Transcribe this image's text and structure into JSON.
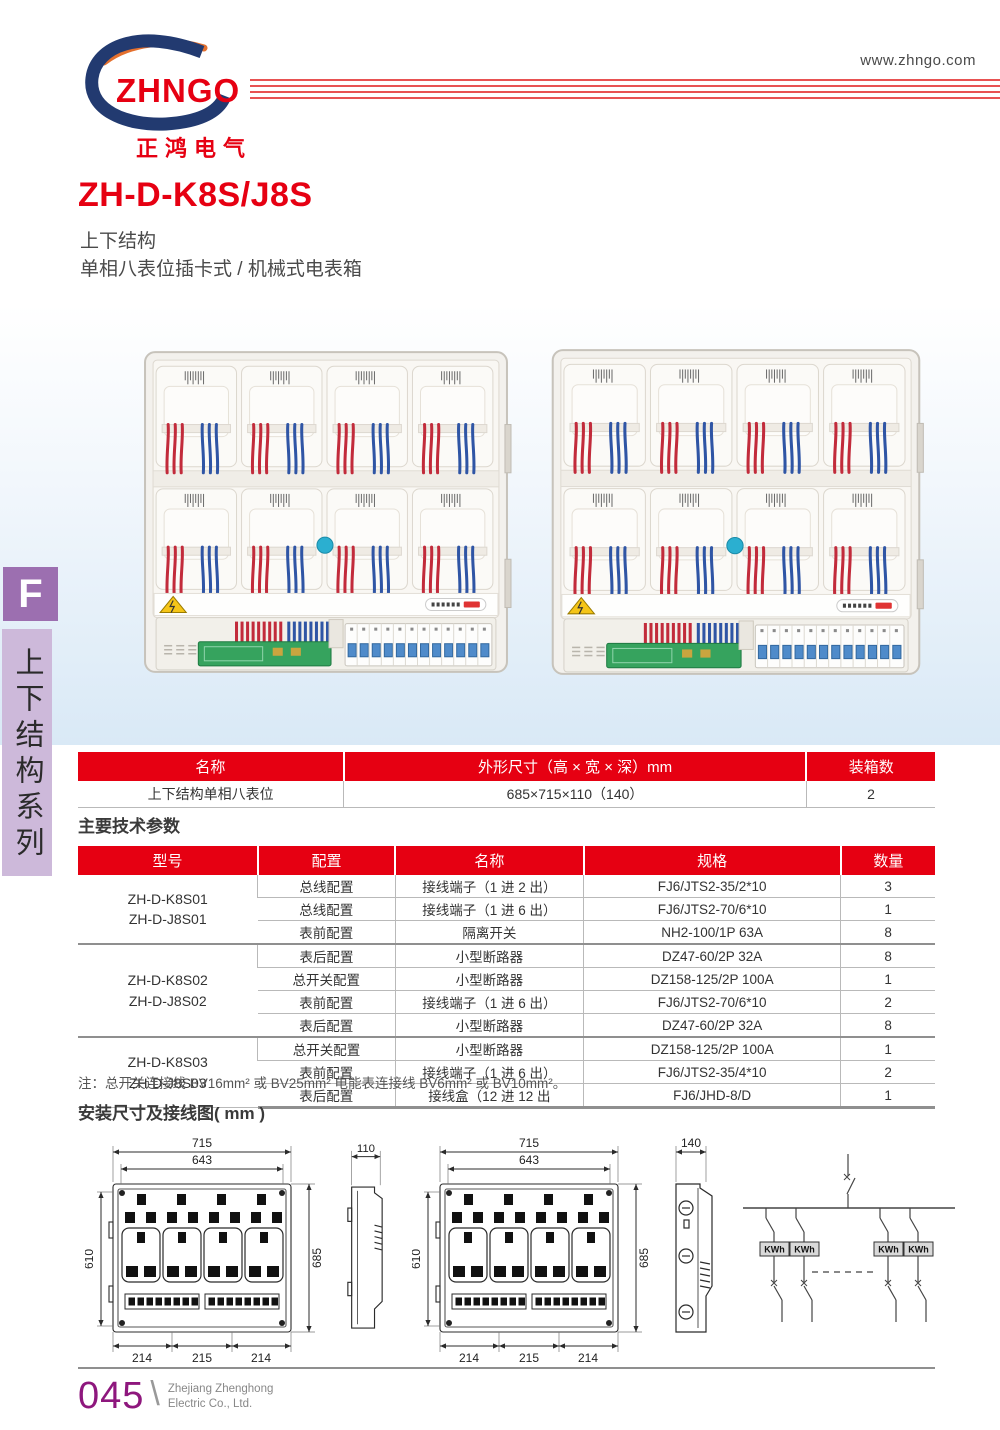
{
  "meta": {
    "website": "www.zhngo.com"
  },
  "logo": {
    "brand": "ZHNGO",
    "company_cn": "正鸿电气"
  },
  "product": {
    "model": "ZH-D-K8S/J8S",
    "subtitle1": "上下结构",
    "subtitle2": "单相八表位插卡式 / 机械式电表箱"
  },
  "sidebar": {
    "tab_letter": "F",
    "series_vertical": "上下结构系列"
  },
  "size_table": {
    "headers": [
      "名称",
      "外形尺寸（高 × 宽 × 深）mm",
      "装箱数"
    ],
    "col_widths": [
      "31%",
      "54%",
      "15%"
    ],
    "rows": [
      [
        "上下结构单相八表位",
        "685×715×110（140）",
        "2"
      ]
    ]
  },
  "tech": {
    "section_title": "主要技术参数",
    "headers": [
      "型号",
      "配置",
      "名称",
      "规格",
      "数量"
    ],
    "col_widths": [
      "21%",
      "16%",
      "22%",
      "30%",
      "11%"
    ],
    "groups": [
      {
        "models": [
          "ZH-D-K8S01",
          "ZH-D-J8S01"
        ],
        "rows": [
          [
            "总线配置",
            "接线端子（1 进 2 出）",
            "FJ6/JTS2-35/2*10",
            "3"
          ],
          [
            "总线配置",
            "接线端子（1 进 6 出）",
            "FJ6/JTS2-70/6*10",
            "1"
          ],
          [
            "表前配置",
            "隔离开关",
            "NH2-100/1P 63A",
            "8"
          ]
        ]
      },
      {
        "models": [
          "ZH-D-K8S02",
          "ZH-D-J8S02"
        ],
        "rows": [
          [
            "表后配置",
            "小型断路器",
            "DZ47-60/2P 32A",
            "8"
          ],
          [
            "总开关配置",
            "小型断路器",
            "DZ158-125/2P 100A",
            "1"
          ],
          [
            "表前配置",
            "接线端子（1 进 6 出）",
            "FJ6/JTS2-70/6*10",
            "2"
          ],
          [
            "表后配置",
            "小型断路器",
            "DZ47-60/2P 32A",
            "8"
          ]
        ]
      },
      {
        "models": [
          "ZH-D-K8S03",
          "ZH-D-J8S03"
        ],
        "rows": [
          [
            "总开关配置",
            "小型断路器",
            "DZ158-125/2P 100A",
            "1"
          ],
          [
            "表前配置",
            "接线端子（1 进 6 出）",
            "FJ6/JTS2-35/4*10",
            "2"
          ],
          [
            "表后配置",
            "接线盒（12 进 12 出",
            "FJ6/JHD-8/D",
            "1"
          ]
        ]
      }
    ]
  },
  "note": "注：总开关连接线 BV16mm² 或 BV25mm² 电能表连接线 BV6mm² 或 BV10mm²。",
  "install": {
    "section_title": "安装尺寸及接线图( mm )",
    "front_dims": {
      "top": "715",
      "inner": "643",
      "left": "610",
      "right": "685",
      "bottom": [
        "214",
        "215",
        "214"
      ]
    },
    "side1_dim": "110",
    "side2_dim": "140",
    "meter_label": "KWh"
  },
  "footer": {
    "page_number": "045",
    "company_en_line1": "Zhejiang Zhenghong",
    "company_en_line2": "Electric Co., Ltd."
  },
  "colors": {
    "accent_red": "#e60012",
    "sidebar_purple": "#9c6fb0",
    "sidebar_light_purple": "#cdb9da",
    "page_number_purple": "#8e177d"
  }
}
